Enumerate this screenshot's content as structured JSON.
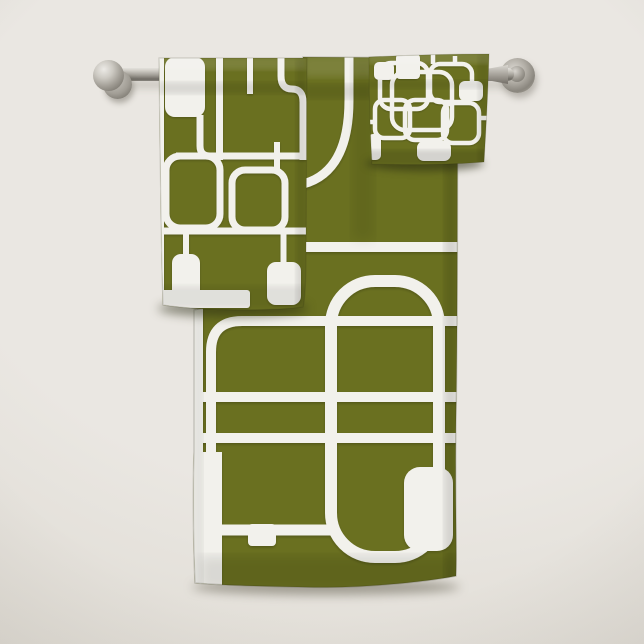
{
  "scene": {
    "description": "Retro geometric pattern towel set in olive green with white rounded-rectangle outlines, hanging on a brushed-nickel wall towel bar",
    "items": [
      {
        "name": "bath-towel"
      },
      {
        "name": "hand-towel"
      },
      {
        "name": "washcloth"
      },
      {
        "name": "towel-bar"
      }
    ]
  },
  "palette": {
    "wall": "#eae7e2",
    "wall-dark": "#ddd9d1",
    "olive": "#6a7020",
    "olive-dark": "#555c14",
    "olive-light": "#788030",
    "pattern-white": "#f2f1ec",
    "metal-light": "#cdcac3",
    "metal-mid": "#a29e96",
    "metal-dark": "#6e6b64"
  }
}
